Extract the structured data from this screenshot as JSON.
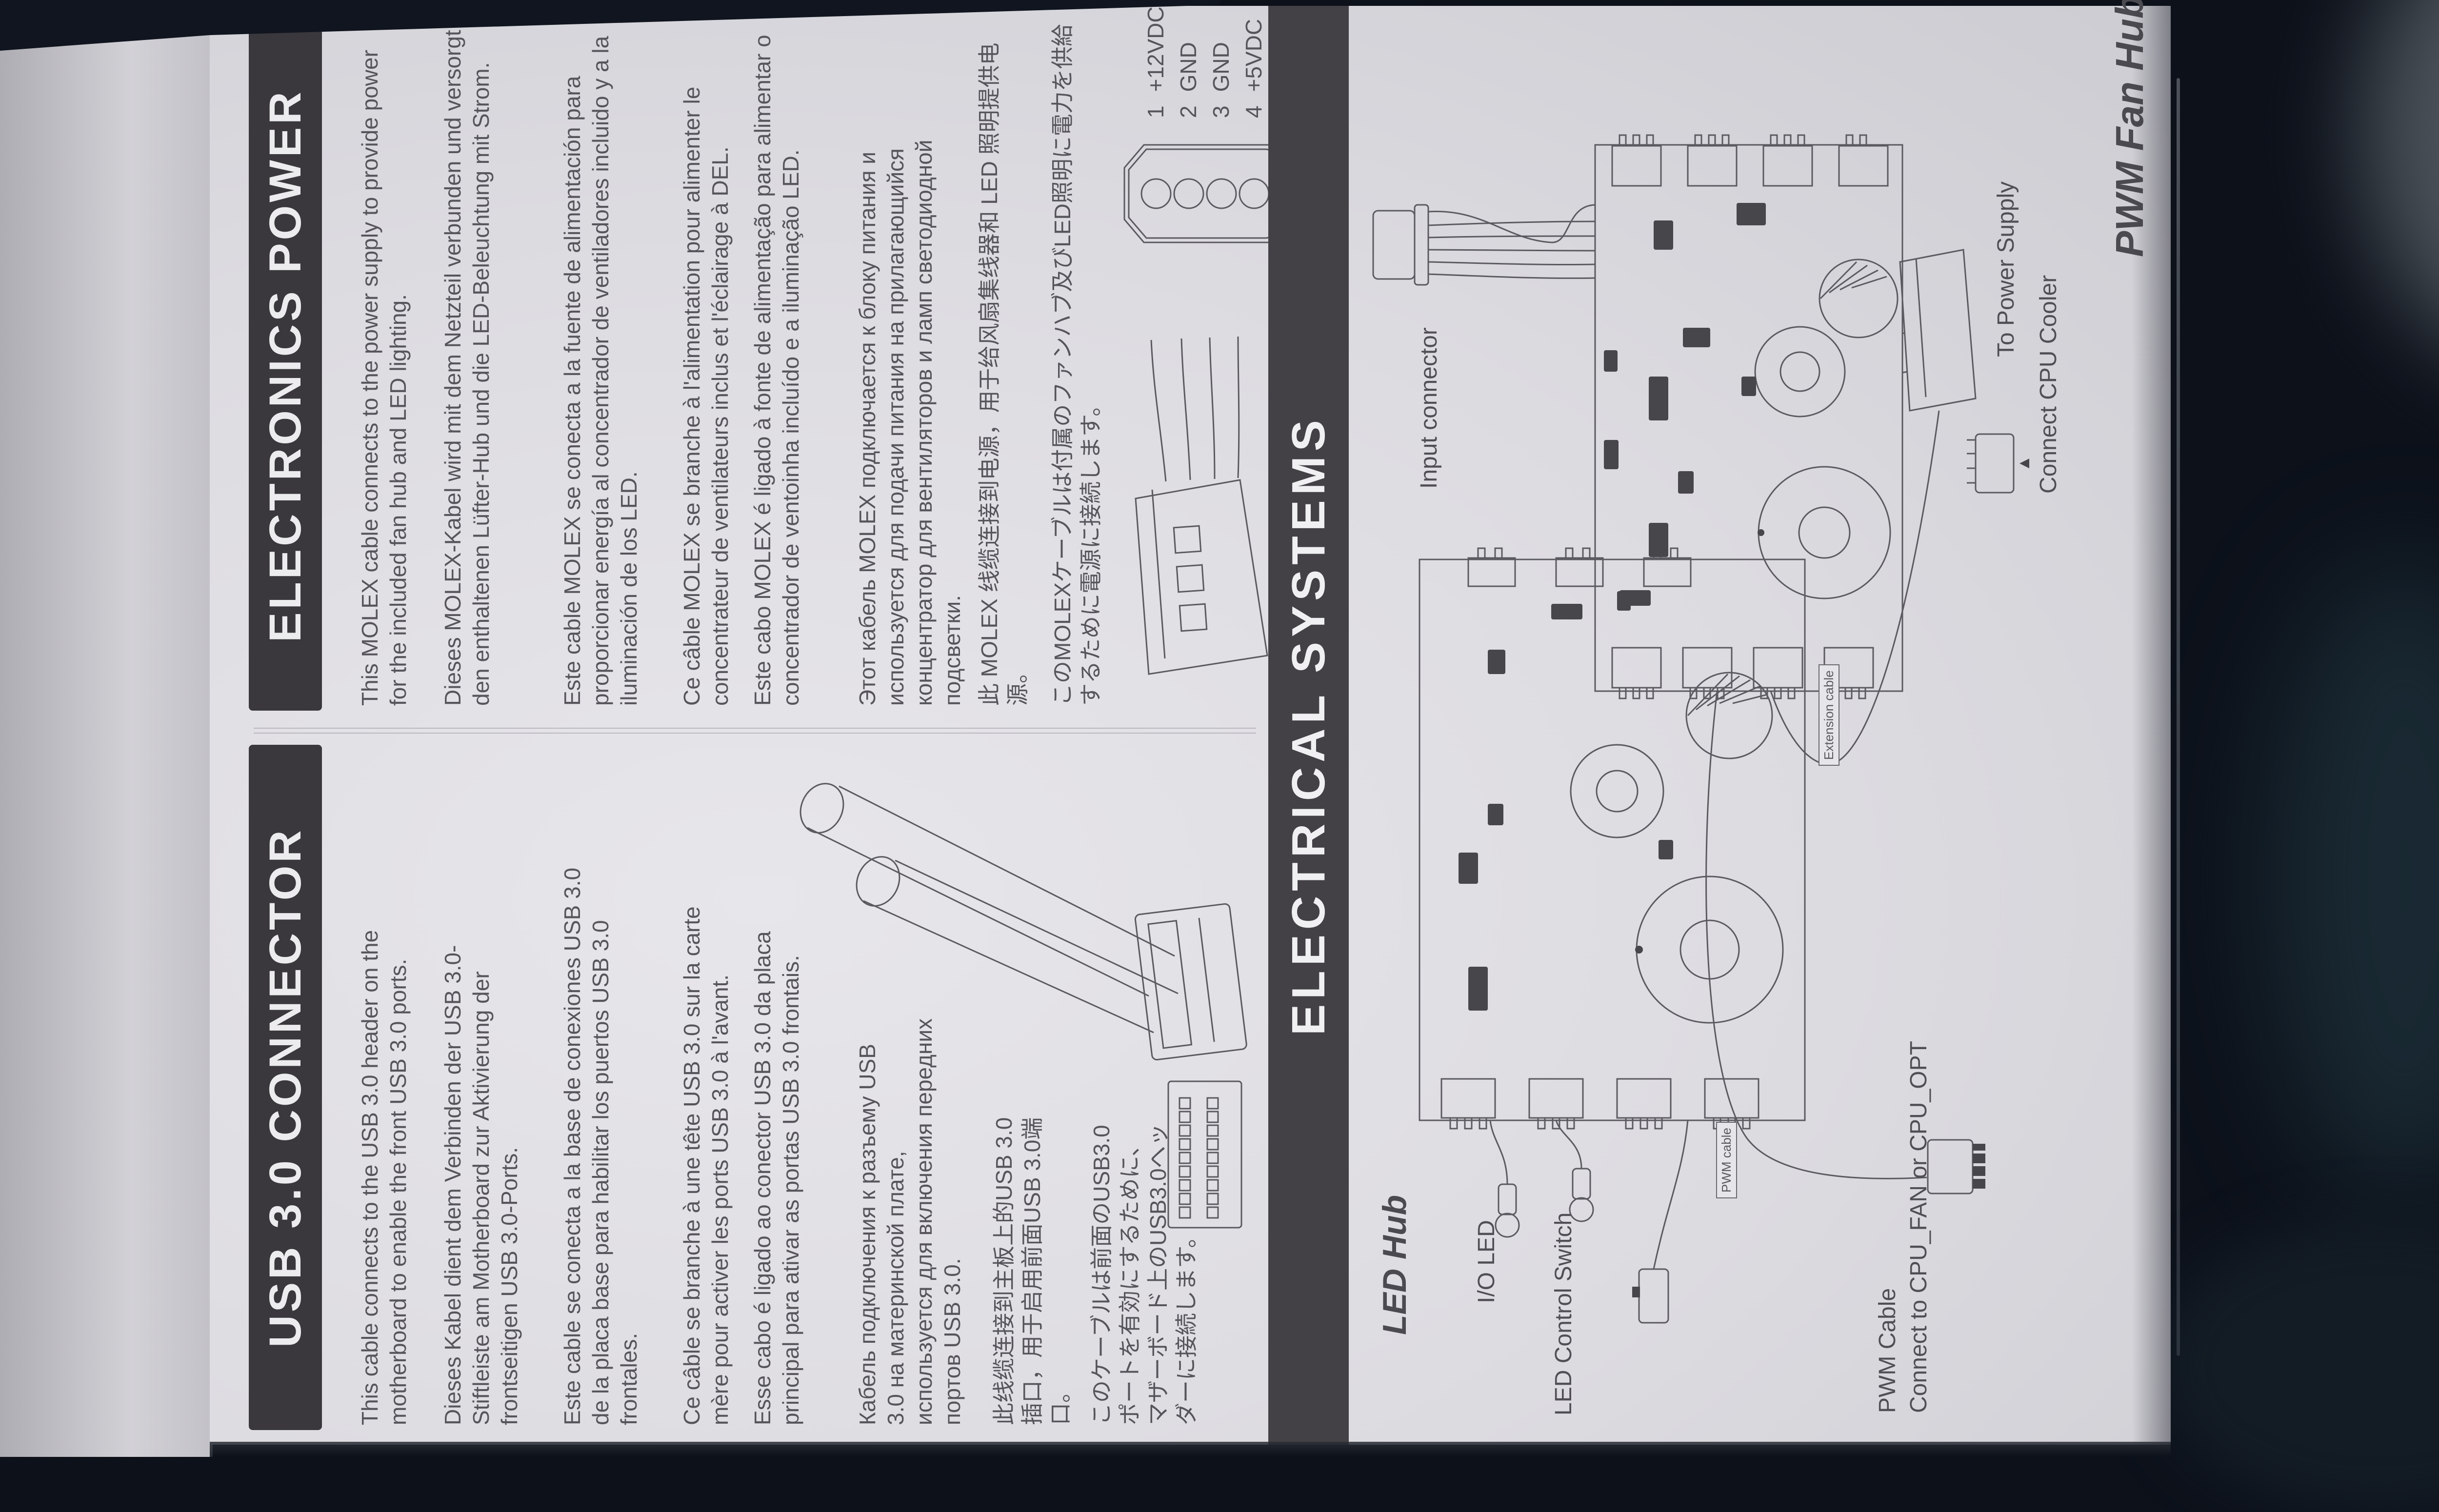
{
  "colors": {
    "background": "#0c111a",
    "paper": "#dddce1",
    "header_bar": "#3a383c",
    "header_text": "#ecebee",
    "body_text": "#56555b",
    "line_art": "#5b5a60"
  },
  "page": {
    "usb": {
      "title": "USB 3.0 CONNECTOR",
      "en": "This cable connects to the USB 3.0 header on the motherboard to enable the front USB 3.0 ports.",
      "de": "Dieses Kabel dient dem Verbinden der USB 3.0-Stiftleiste am Motherboard zur Aktivierung der frontseitigen USB 3.0-Ports.",
      "es": "Este cable se conecta a la base de conexiones USB 3.0 de la placa base para habilitar los puertos USB 3.0 frontales.",
      "fr": "Ce câble se branche à une tête USB 3.0 sur la carte mère pour activer les ports USB 3.0 à l'avant.",
      "pt": "Esse cabo é ligado ao conector USB 3.0 da placa principal para ativar as portas USB 3.0 frontais.",
      "ru": "Кабель подключения к разъему USB 3.0 на материнской плате, используется для включения передних портов USB 3.0.",
      "zh": "此线缆连接到主板上的USB 3.0插口，用于启用前面USB 3.0端口。",
      "ja": "このケーブルは前面のUSB3.0ポートを有効にするために、マザーボード上のUSB3.0ヘッダーに接続します。"
    },
    "power": {
      "title": "ELECTRONICS POWER",
      "en": "This MOLEX cable connects to the power supply to provide power for the included fan hub and LED lighting.",
      "de": "Dieses MOLEX-Kabel wird mit dem Netzteil verbunden und versorgt den enthaltenen Lüfter-Hub und die LED-Beleuchtung mit Strom.",
      "es": "Este cable MOLEX se conecta a la fuente de alimentación para proporcionar energía al concentrador de ventiladores incluido y a la iluminación de los LED.",
      "fr": "Ce câble MOLEX se branche à l'alimentation pour alimenter le concentrateur de ventilateurs inclus et l'éclairage à DEL.",
      "pt": "Este cabo MOLEX é ligado à fonte de alimentação para alimentar o concentrador de ventoinha incluído e a iluminação LED.",
      "ru": "Этот кабель MOLEX подключается к блоку питания и используется для подачи питания на прилагающийся концентратор для вентиляторов и ламп светодиодной подсветки.",
      "zh": "此 MOLEX 线缆连接到电源，用于给风扇集线器和 LED 照明提供电源。",
      "ja": "このMOLEXケーブルは付属のファンハブ及びLED照明に電力を供給するために電源に接続します。",
      "pins": [
        {
          "num": "1",
          "label": "+12VDC"
        },
        {
          "num": "2",
          "label": "GND"
        },
        {
          "num": "3",
          "label": "GND"
        },
        {
          "num": "4",
          "label": "+5VDC"
        }
      ]
    },
    "electrical": {
      "title": "ELECTRICAL SYSTEMS",
      "led_hub": {
        "title": "LED Hub",
        "io_led": "I/O LED",
        "control_switch": "LED Control Switch"
      },
      "pwm_hub": {
        "title": "PWM Fan Hub",
        "input": "Input connector",
        "to_psu": "To Power Supply",
        "cooler": "Connect CPU Cooler",
        "cooler_arrow": "▲",
        "pwm_cable_line1": "PWM Cable",
        "pwm_cable_line2": "Connect to CPU_FAN or CPU_OPT",
        "extension_cable": "Extension cable",
        "pwm_cable_small": "PWM cable"
      }
    }
  }
}
